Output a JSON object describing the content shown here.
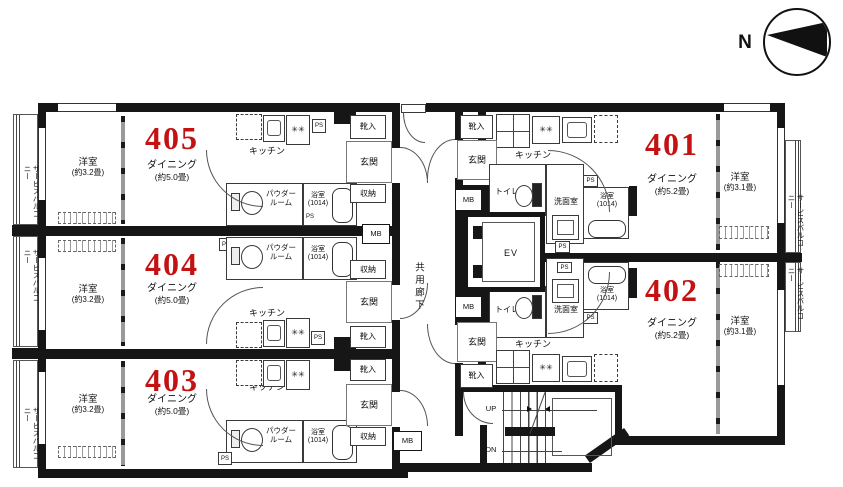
{
  "compass": {
    "north": "N"
  },
  "colors": {
    "wall": "#161616",
    "unit_number": "#c41212"
  },
  "common": {
    "corridor": "共用廊下",
    "elevator": "EV",
    "mb": "MB",
    "ps": "PS",
    "up": "UP",
    "dn": "DN",
    "service_balcony": "サービスバルコニー",
    "stove_symbol": "✳"
  },
  "units": [
    {
      "number": "405",
      "bedroom": "洋室",
      "bedroom_size": "(約3.2畳)",
      "dining": "ダイニング",
      "dining_size": "(約5.0畳)",
      "kitchen": "キッチン",
      "powder1": "パウダー",
      "powder2": "ルーム",
      "bath": "浴室",
      "bath_size": "(1014)",
      "entrance": "玄関",
      "closet": "収納",
      "shoes": "靴入"
    },
    {
      "number": "404",
      "bedroom": "洋室",
      "bedroom_size": "(約3.2畳)",
      "dining": "ダイニング",
      "dining_size": "(約5.0畳)",
      "kitchen": "キッチン",
      "powder1": "パウダー",
      "powder2": "ルーム",
      "bath": "浴室",
      "bath_size": "(1014)",
      "entrance": "玄関",
      "closet": "収納",
      "shoes": "靴入"
    },
    {
      "number": "403",
      "bedroom": "洋室",
      "bedroom_size": "(約3.2畳)",
      "dining": "ダイニング",
      "dining_size": "(約5.0畳)",
      "kitchen": "キッチン",
      "powder1": "パウダー",
      "powder2": "ルーム",
      "bath": "浴室",
      "bath_size": "(1014)",
      "entrance": "玄関",
      "closet": "収納",
      "shoes": "靴入"
    },
    {
      "number": "401",
      "bedroom": "洋室",
      "bedroom_size": "(約3.1畳)",
      "dining": "ダイニング",
      "dining_size": "(約5.2畳)",
      "kitchen": "キッチン",
      "toilet": "トイレ",
      "washroom": "洗面室",
      "bath": "浴室",
      "bath_size": "(1014)",
      "entrance": "玄関",
      "shoes": "靴入"
    },
    {
      "number": "402",
      "bedroom": "洋室",
      "bedroom_size": "(約3.1畳)",
      "dining": "ダイニング",
      "dining_size": "(約5.2畳)",
      "kitchen": "キッチン",
      "toilet": "トイレ",
      "washroom": "洗面室",
      "bath": "浴室",
      "bath_size": "(1014)",
      "entrance": "玄関",
      "shoes": "靴入"
    }
  ]
}
